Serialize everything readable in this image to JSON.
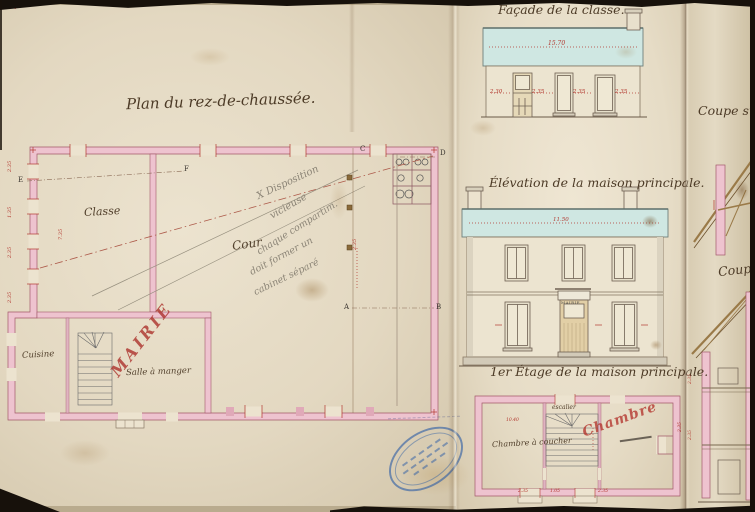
{
  "titles": {
    "ground_plan": "Plan du rez-de-chaussée.",
    "facade": "Façade de la classe.",
    "elevation": "Élévation de la maison principale.",
    "first_floor": "1er Étage de la maison principale.",
    "section_1": "Coupe sui",
    "section_2": "Coupe"
  },
  "rooms": {
    "classe": "Classe",
    "cour": "Cour",
    "cuisine": "Cuisine",
    "salle_a_manger": "Salle à manger",
    "chambre_a_coucher": "Chambre à coucher",
    "escalier": "escalier"
  },
  "stamps": {
    "mairie": "MAIRIE",
    "chambre": "Chambre",
    "door_plaque": "MAIRIE"
  },
  "pencil_note": {
    "line1": "X Disposition",
    "line2": "vicieuse",
    "line3": "chaque compartim.",
    "line4": "doit former un",
    "line5": "cabinet séparé"
  },
  "dimensions": {
    "facade_width": "15.70",
    "facade_bays": [
      "2.30",
      "2.35",
      "2.35",
      "2.35"
    ],
    "elevation_width": "11.50",
    "plan_left_wall": [
      "2.35",
      "1.35",
      "2.35",
      "2.35"
    ],
    "classe_depth": "7.35",
    "mid_wall": "2.35",
    "first_floor_width": "10.40",
    "first_floor_bottom": [
      "2.35",
      "1.05",
      "2.35"
    ],
    "first_floor_right": "2.35",
    "section_dims": [
      "2.35",
      "2.35"
    ]
  },
  "markers": {
    "a": "A",
    "b": "B",
    "c": "C",
    "d": "D",
    "e": "E",
    "f": "F"
  },
  "misc": {
    "corner_cross": "+"
  },
  "colors": {
    "wall_pink": "#eec3cf",
    "roof_blue": "#cfe7e2",
    "ink_sepia": "#4c3a26",
    "dimension_red": "#b2372e",
    "stamp_red": "#b43430",
    "archive_stamp_blue": "#2d5faa"
  }
}
